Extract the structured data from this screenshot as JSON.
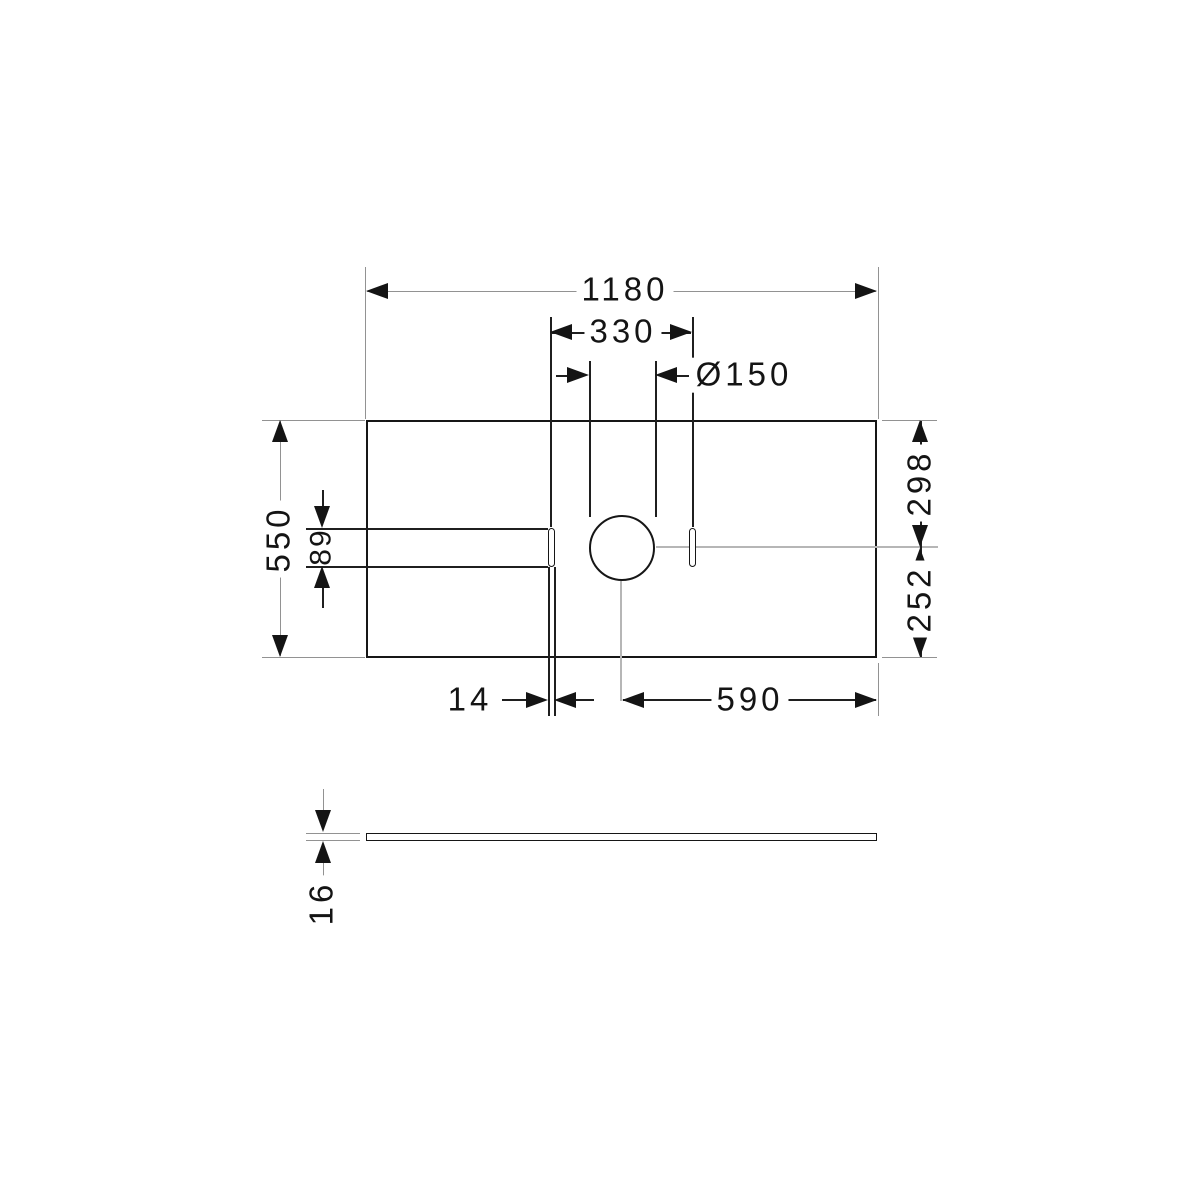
{
  "drawing": {
    "title": "technical dimension drawing",
    "part": "console plate with tap hole and two slots",
    "units": "mm",
    "views": {
      "top": "top view",
      "side": "side view"
    },
    "colors": {
      "outline": "#161616",
      "dimension_line": "#1f1f1f",
      "extension_line": "#929292",
      "center_line": "#b6b6b6",
      "background": "#ffffff"
    },
    "dimensions": {
      "overall_width": "1180",
      "slot_spacing": "330",
      "hole_diameter": "Ø150",
      "overall_depth": "550",
      "slot_length": "89",
      "depth_to_center_top": "298",
      "depth_to_center_bottom": "252",
      "slot_width": "14",
      "hole_center_to_right_edge": "590",
      "plate_thickness": "16"
    }
  }
}
